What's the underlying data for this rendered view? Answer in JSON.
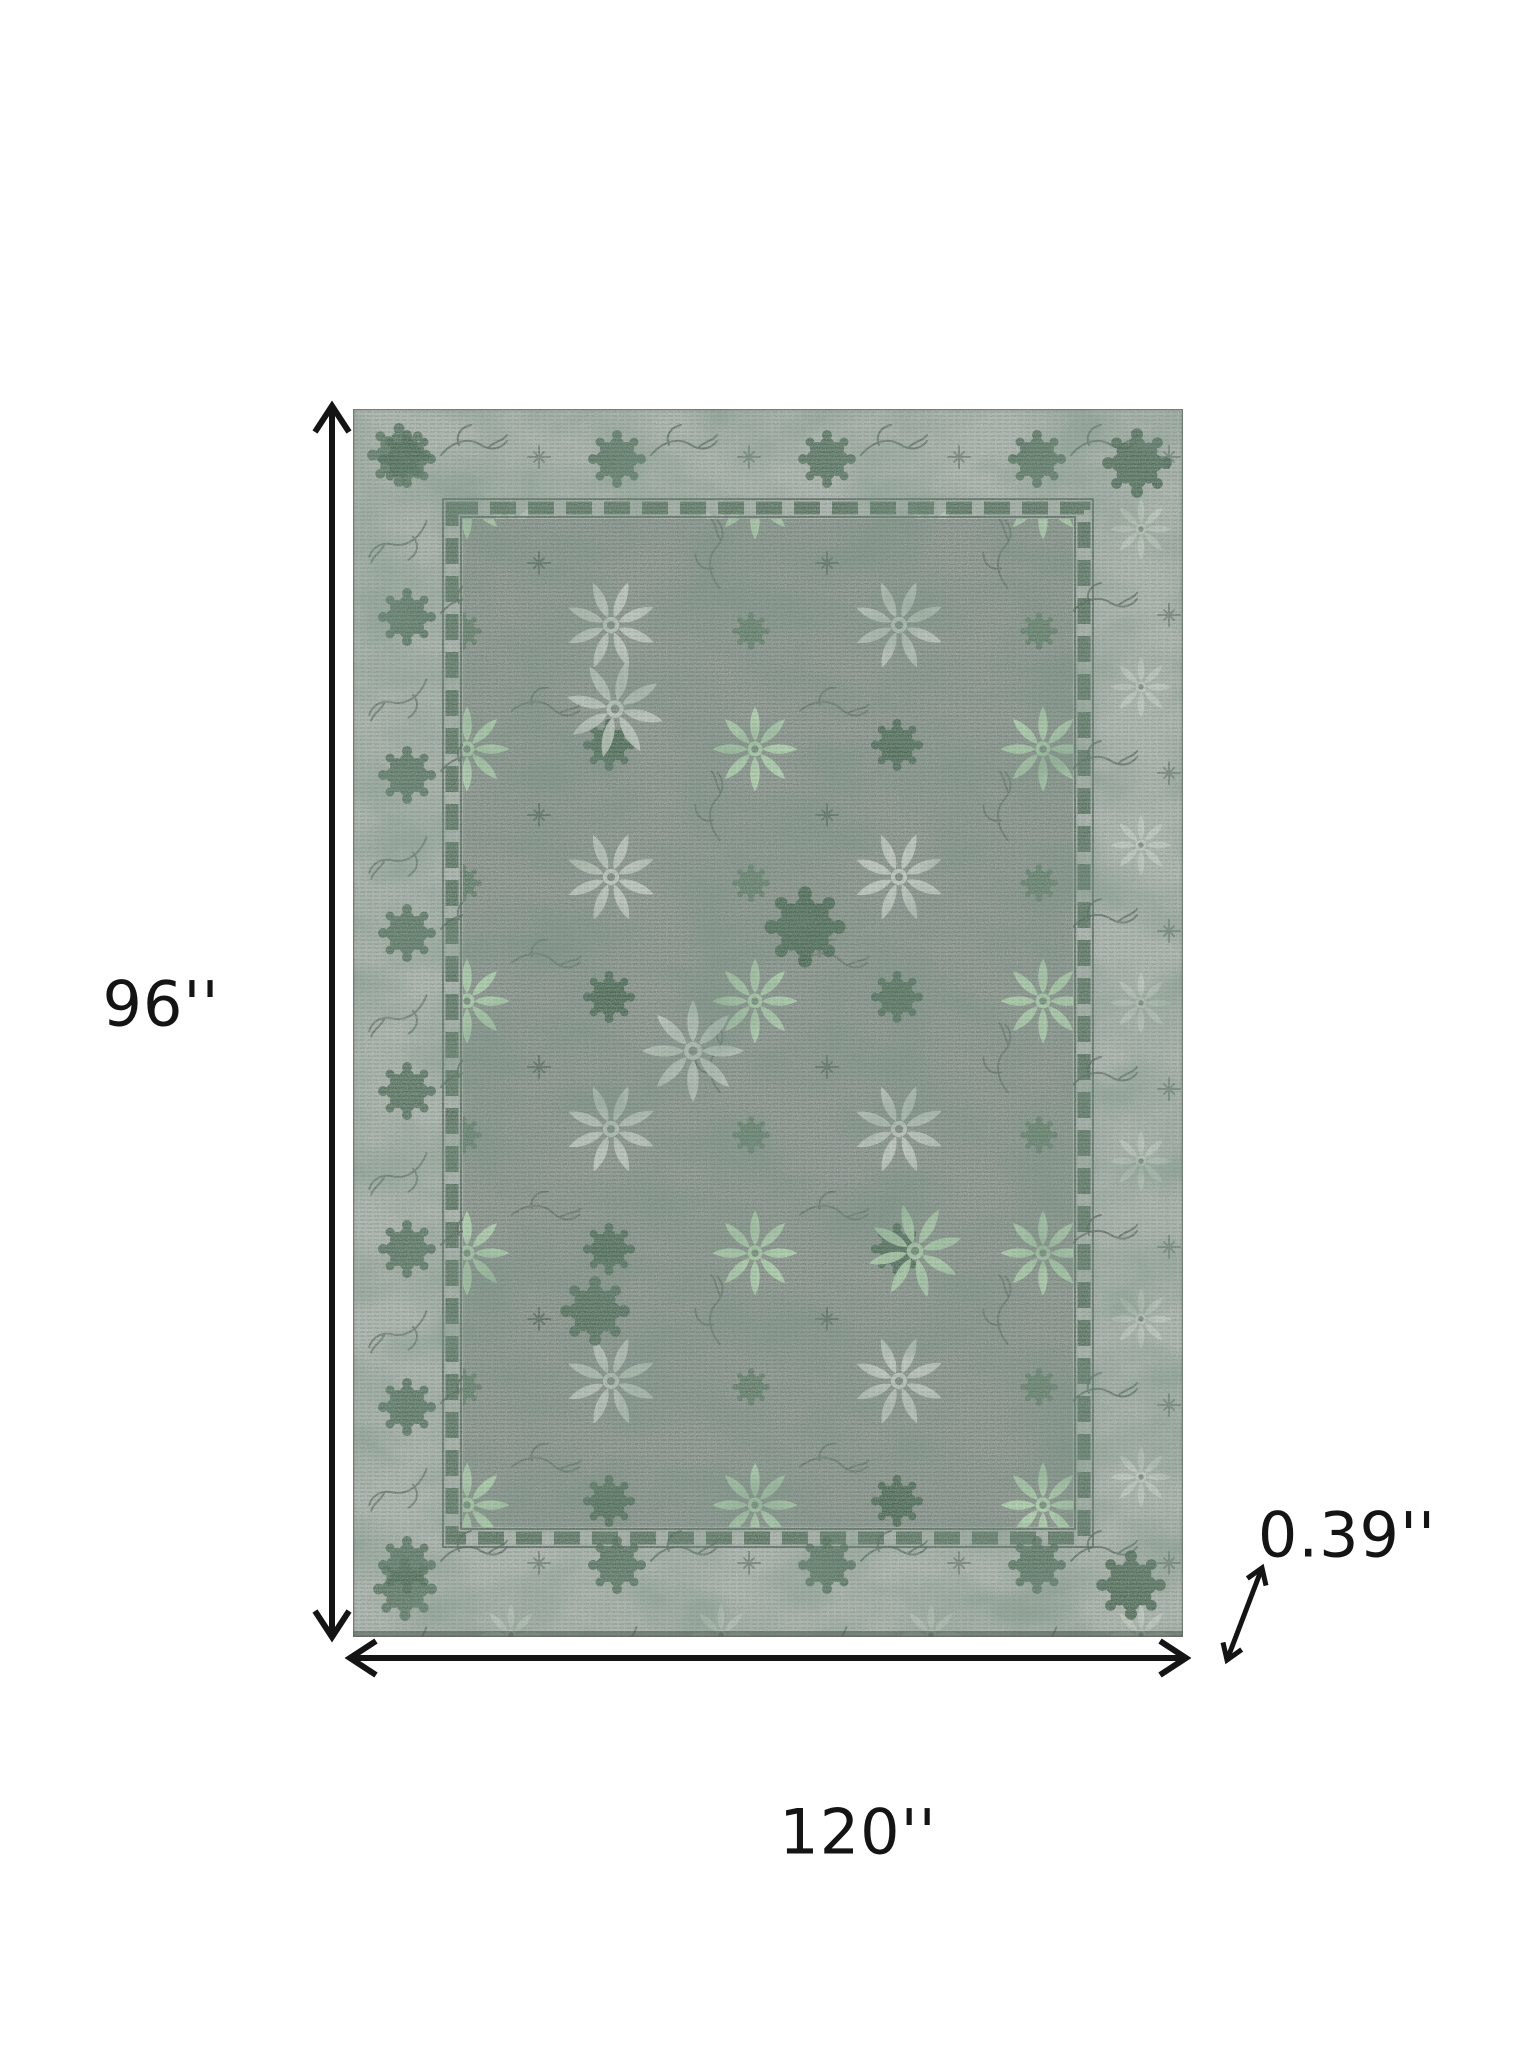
{
  "page": {
    "background_color": "#ffffff"
  },
  "diagram": {
    "type": "rug-dimension-diagram",
    "labels": {
      "height": "96''",
      "width": "120''",
      "thickness": "0.39''"
    },
    "icons": {
      "height_arrow": "vertical-double-arrow-icon",
      "width_arrow": "horizontal-double-arrow-icon",
      "thickness_arrow": "diagonal-double-arrow-icon"
    },
    "colors": {
      "arrow": "#141414",
      "label_text": "#141414",
      "rug_border_background": "#a1aba3",
      "rug_field_background": "#828d85",
      "rug_dark_green": "#466450",
      "rug_mint_green": "#a7c9a6",
      "rug_pale_gray": "#b6c0b7",
      "rug_outline": "#4c5e52"
    }
  }
}
